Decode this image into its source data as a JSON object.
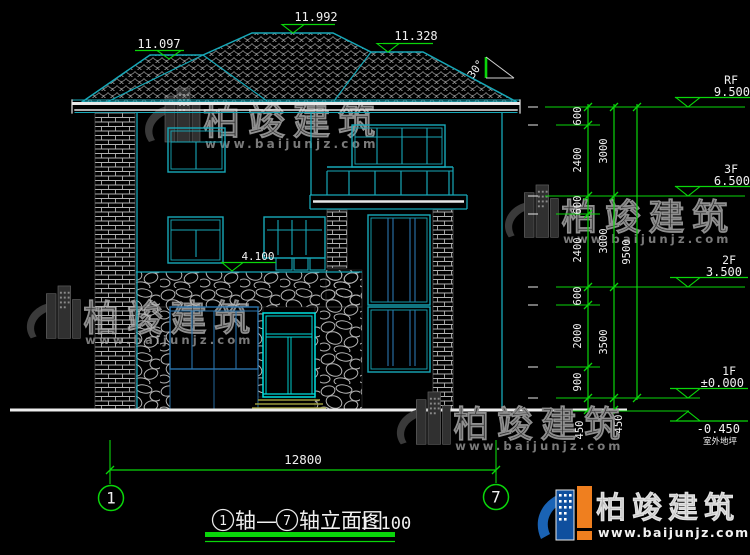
{
  "drawing": {
    "roof_dims": {
      "left": "11.097",
      "main": "11.992",
      "right": "11.328"
    },
    "slope": "30°",
    "stone_top_dim": "4.100",
    "levels": [
      {
        "label": "RF",
        "elev": "9.500"
      },
      {
        "label": "3F",
        "elev": "6.500"
      },
      {
        "label": "2F",
        "elev": "3.500"
      },
      {
        "label": "1F",
        "elev": "±0.000"
      },
      {
        "label": "",
        "elev": "-0.450",
        "sub": "室外地坪"
      }
    ],
    "dims_col1": [
      "600",
      "2400",
      "600",
      "2400",
      "600",
      "2000",
      "900",
      "450"
    ],
    "dims_col2": [
      "3000",
      "3000",
      "3500",
      "450"
    ],
    "dims_col3": [
      "9500"
    ],
    "bottom_dim": "12800",
    "axes": [
      "1",
      "7"
    ],
    "title": {
      "prefix_axis": "1",
      "mid": "轴—",
      "suffix_axis": "7",
      "name": "轴立面图",
      "scale": "1:100"
    }
  },
  "watermark": {
    "brand": "柏竣建筑",
    "url": "www.baijunjz.com"
  },
  "footer": {
    "brand": "柏竣建筑",
    "url": "www.baijunjz.com"
  }
}
